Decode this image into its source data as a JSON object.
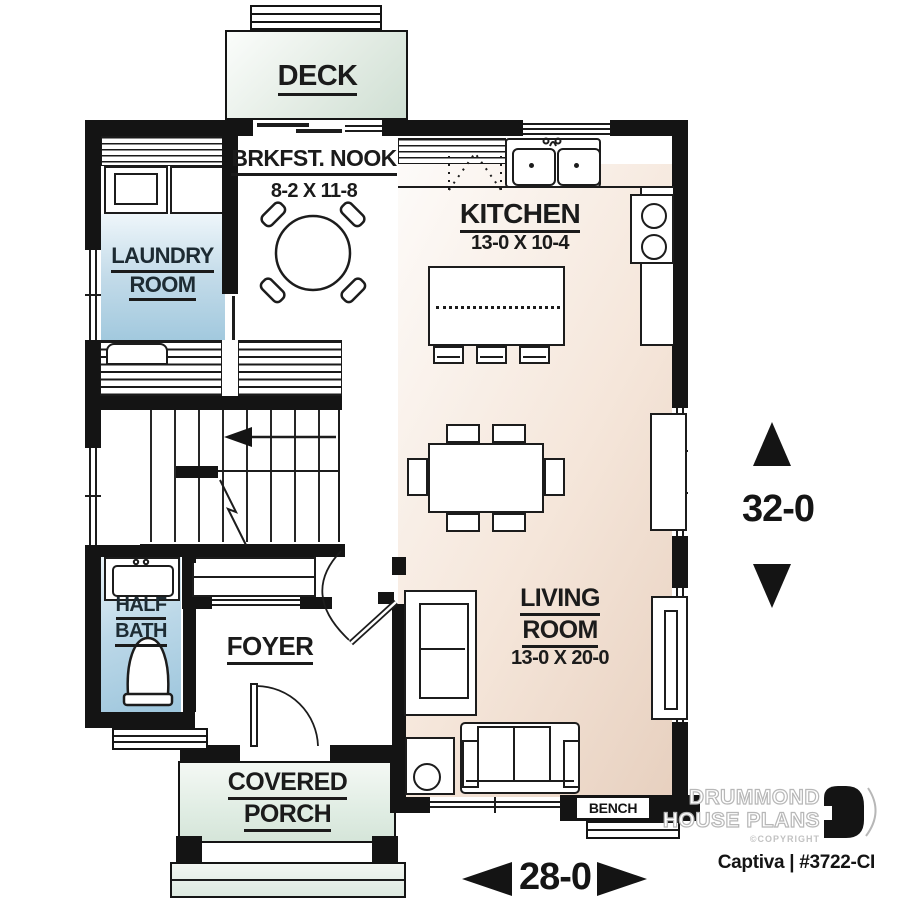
{
  "brand": {
    "line1": "DRUMMOND",
    "line2": "HOUSE PLANS",
    "copyright": "©COPYRIGHT",
    "plan_id": "Captiva | #3722-CI"
  },
  "dimensions": {
    "width": "28-0",
    "height": "32-0"
  },
  "rooms": {
    "deck": {
      "label": "DECK"
    },
    "nook": {
      "label": "BRKFST. NOOK",
      "size": "8-2 X 11-8"
    },
    "kitchen": {
      "label": "KITCHEN",
      "size": "13-0 X 10-4"
    },
    "laundry": {
      "label1": "LAUNDRY",
      "label2": "ROOM"
    },
    "half_bath": {
      "label1": "HALF",
      "label2": "BATH"
    },
    "foyer": {
      "label": "FOYER"
    },
    "living": {
      "label1": "LIVING",
      "label2": "ROOM",
      "size": "13-0 X 20-0"
    },
    "porch": {
      "label1": "COVERED",
      "label2": "PORCH"
    },
    "bench": {
      "label": "BENCH"
    }
  },
  "colors": {
    "wall": "#141414",
    "living_kitchen_fill": "#e9d5c6",
    "laundry_fill": "#a5cbe0",
    "half_bath_fill": "#a5cadf",
    "deck_fill": "#d4e1d6",
    "porch_fill": "#dce9df",
    "label_text": "#1b1b1b",
    "brand_gray": "#b7b7b7"
  }
}
